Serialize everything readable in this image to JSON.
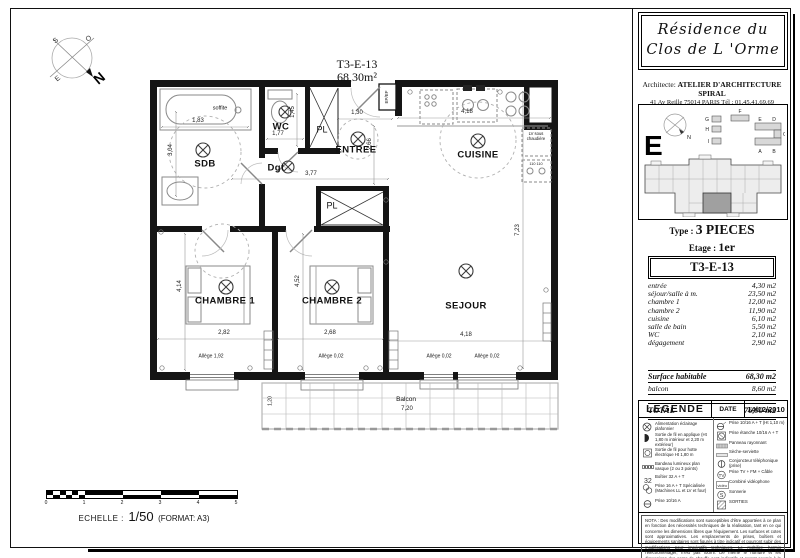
{
  "plan": {
    "title": "T3-E-13",
    "area": "68,30m²",
    "rooms": {
      "sdb": "SDB",
      "wc": "WC",
      "dgt": "Dgt",
      "entree": "ENTREE",
      "pl1": "PL",
      "pl2": "PL",
      "cuisine": "CUISINE",
      "chambre1": "CHAMBRE 1",
      "chambre2": "CHAMBRE 2",
      "sejour": "SEJOUR",
      "balcon": "Balcon"
    },
    "annotations": {
      "soffite": "soffite",
      "epef": "EP/EF",
      "lv": "LV sous chaudière",
      "lv2": "110 110"
    },
    "dims": {
      "sdb_w": "1,83",
      "sdb_h": "3,04",
      "wc_w": "1,77",
      "wc_h": "1,45",
      "entree_w": "1,30",
      "entree_h": "2,66",
      "dgt_w": "3,77",
      "cuisine_w": "4,18",
      "sejour_right_h": "7,23",
      "ch1_h": "4,14",
      "ch1_w": "2,82",
      "ch2_h": "4,52",
      "ch2_w": "2,68",
      "sejour_w": "4,18",
      "balcon_w": "7,20",
      "balcon_h": "1,20",
      "allege_ch1": "Allège 1,92",
      "allege_ch2": "Allège 0,02",
      "allege_sej1": "Allège 0,02",
      "allege_sej2": "Allège 0,02"
    }
  },
  "compass": {
    "n": "N",
    "s": "S",
    "e": "E",
    "o": "O"
  },
  "scalebar": {
    "label": "ECHELLE :",
    "ratio": "1/50",
    "format": "(FORMAT: A3)",
    "ticks": [
      "0",
      "1",
      "2",
      "3",
      "4",
      "5"
    ]
  },
  "sidebar": {
    "residence_title_line1": "Résidence du",
    "residence_title_line2": "Clos de L 'Orme",
    "architect_prefix": "Architecte:",
    "architect_name": "ATELIER D'ARCHITECTURE SPIRAL",
    "architect_address": "41 Av Reille 75014 PARIS Tél : 01.45.41.69.69",
    "keyplan": {
      "letters": {
        "big": "E",
        "north": "N",
        "a": "A",
        "b": "B",
        "c": "C",
        "d": "D",
        "e": "E",
        "f": "F",
        "g": "G",
        "h": "H",
        "i": "I"
      }
    },
    "type_label": "Type :",
    "type_value": "3 PIECES",
    "floor_label": "Etage :",
    "floor_value": "1er",
    "table": {
      "header": "T3-E-13",
      "rows": [
        [
          "entrée",
          "4,30 m2"
        ],
        [
          "séjour/salle à m.",
          "23,50 m2"
        ],
        [
          "chambre 1",
          "12,00 m2"
        ],
        [
          "chambre 2",
          "11,90 m2"
        ],
        [
          "cuisine",
          "6,10 m2"
        ],
        [
          "salle de bain",
          "5,50 m2"
        ],
        [
          "WC",
          "2,10 m2"
        ],
        [
          "dégagement",
          "2,90 m2"
        ]
      ],
      "subtotal_label": "Surface habitable",
      "subtotal_value": "68,30 m2",
      "balcony_label": "balcon",
      "balcony_value": "8,60 m2",
      "total_label": "TOTAL",
      "total_value": "76,90 m2"
    },
    "legend": {
      "title": "LEGENDE",
      "date_label": "DATE",
      "date_value": "14/12/2010",
      "left_items": [
        "Alimentation éclairage plafonnier",
        "Sortie de fil en applique (Ht 1,80 m intérieur et 2,20 m extérieur)",
        "Sortie de fil pour hotte électrique Ht 1,80 m",
        "Bandeau lumineux plan vasque (2 ou 3 points)",
        "Boîtier 32 A + T",
        "Prise 16 A + T Spécialisée (Machines LL et LV et four)",
        "Prise 10/16 A"
      ],
      "right_items": [
        "Prise 10/16 A + T (Ht 1,10 m)",
        "Prise étanche 10/16 A + T",
        "Panneau rayonnant",
        "Sèche-serviette",
        "Conjoncteur téléphonique (prise)",
        "Prise TV + FM + Câble",
        "Combiné vidéophone",
        "Sonnerie",
        "SORTIES"
      ],
      "glyphs": {
        "b32": "32",
        "tv": "TV",
        "s": "S",
        "video": "vidéo"
      },
      "note": "NOTA : Des modifications sont susceptibles d'être apportées à ce plan en fonction des nécessités techniques de la réalisation, tant en ce qui concerne les dimensions libres que l'équipement. Les surfaces et cotes sont approximatives. Les emplacements de prises, boîtiers et équipements sanitaires sont figurés à titre indicatif et pourront subir des modifications pour impératifs techniques. Le mobilier, hormis l'électroménager, n'est pas fourni. De même le nombre et les dimensions des corps de chauffe sont indicatifs et seront soumis à la conformité de l'étude thermique."
    }
  }
}
